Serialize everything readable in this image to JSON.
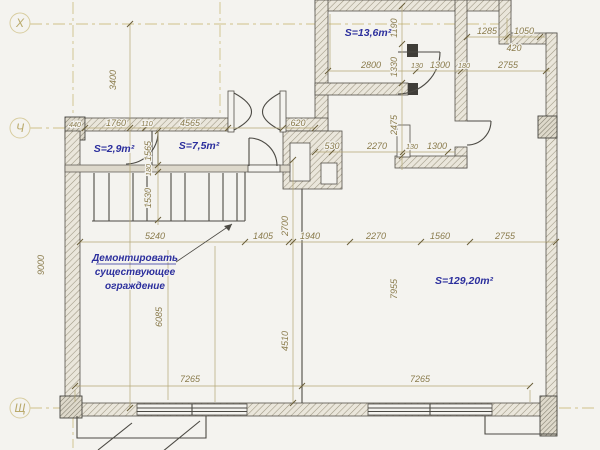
{
  "drawing": {
    "kind": "floor-plan",
    "colors": {
      "paper": "#f4f3ef",
      "dim_text": "#8a7b4c",
      "dim_line": "#b3a674",
      "axis": "#cfc289",
      "annotation_blue": "#2c2f9d",
      "wall_stroke": "#54514a"
    }
  },
  "axis_markers": {
    "top": "Х",
    "middle": "Ч",
    "bottom": "Щ"
  },
  "axis_dims": {
    "top_span": "3400",
    "bottom_span": "9000"
  },
  "rooms": {
    "r1": "S=13,6m²",
    "r2": "S=2,9m²",
    "r3": "S=7,5m²",
    "r4": "S=129,20m²"
  },
  "note": [
    "Демонтировать",
    "существующее",
    "ограждение"
  ],
  "dims": {
    "top1": [
      "1285",
      "1050"
    ],
    "top_420": "420",
    "top2": [
      "2800",
      "130",
      "1300",
      "180",
      "2755"
    ],
    "vchain": [
      "1190",
      "1330",
      "2475"
    ],
    "ch_row": [
      "440",
      "1760",
      "110",
      "4565",
      "620"
    ],
    "mid_row": [
      "530",
      "2270",
      "130",
      "1300"
    ],
    "stair_chain": [
      "1565",
      "180",
      "1530"
    ],
    "main_row": [
      "5240",
      "1405",
      "1940",
      "2270",
      "1560",
      "2755"
    ],
    "v_2700": "2700",
    "v_6085": "6085",
    "v_4510": "4510",
    "v_7955": "7955",
    "bottom": [
      "7265",
      "7265"
    ]
  }
}
